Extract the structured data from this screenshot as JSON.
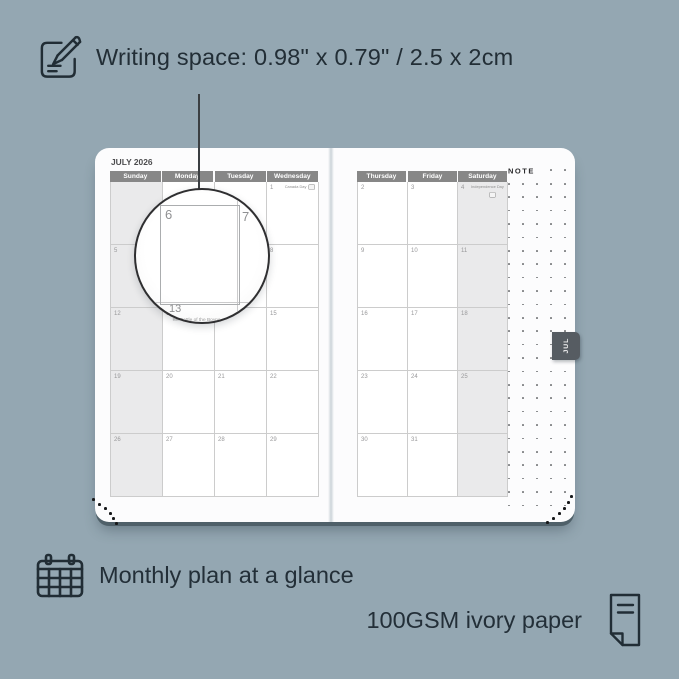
{
  "colors": {
    "background": "#94a7b2",
    "page": "#fcfcfd",
    "header_gray": "#878787",
    "shaded_column": "#eaeaeb",
    "tab_gray": "#565c62",
    "caption_text": "#232f38"
  },
  "top_caption": {
    "text": "Writing space: 0.98\" x 0.79\" / 2.5 x 2cm"
  },
  "planner": {
    "month_title": "JULY 2026",
    "note_label": "NOTE",
    "month_tab": "JUL",
    "left_page": {
      "day_headers": [
        "Sunday",
        "Monday",
        "Tuesday",
        "Wednesday"
      ],
      "weeks": [
        [
          "",
          "",
          "",
          "1"
        ],
        [
          "5",
          "6",
          "7",
          "8"
        ],
        [
          "12",
          "13",
          "14",
          "15"
        ],
        [
          "19",
          "20",
          "21",
          "22"
        ],
        [
          "26",
          "27",
          "28",
          "29"
        ]
      ]
    },
    "right_page": {
      "day_headers": [
        "Thursday",
        "Friday",
        "Saturday"
      ],
      "weeks": [
        [
          "2",
          "3",
          "4"
        ],
        [
          "9",
          "10",
          "11"
        ],
        [
          "16",
          "17",
          "18"
        ],
        [
          "23",
          "24",
          "25"
        ],
        [
          "30",
          "31",
          ""
        ]
      ]
    },
    "holidays": [
      {
        "date": "1",
        "label": "Canada Day"
      },
      {
        "date": "4",
        "label": "Independence Day"
      },
      {
        "date": "13",
        "label": "Battle of the Boyne"
      }
    ],
    "lens": {
      "day_left": "6",
      "day_right": "7",
      "day_below": "13",
      "holiday_below": "Battle of the Boyne"
    }
  },
  "bottom_captions": {
    "monthly": "Monthly plan at a glance",
    "paper": "100GSM ivory paper"
  }
}
